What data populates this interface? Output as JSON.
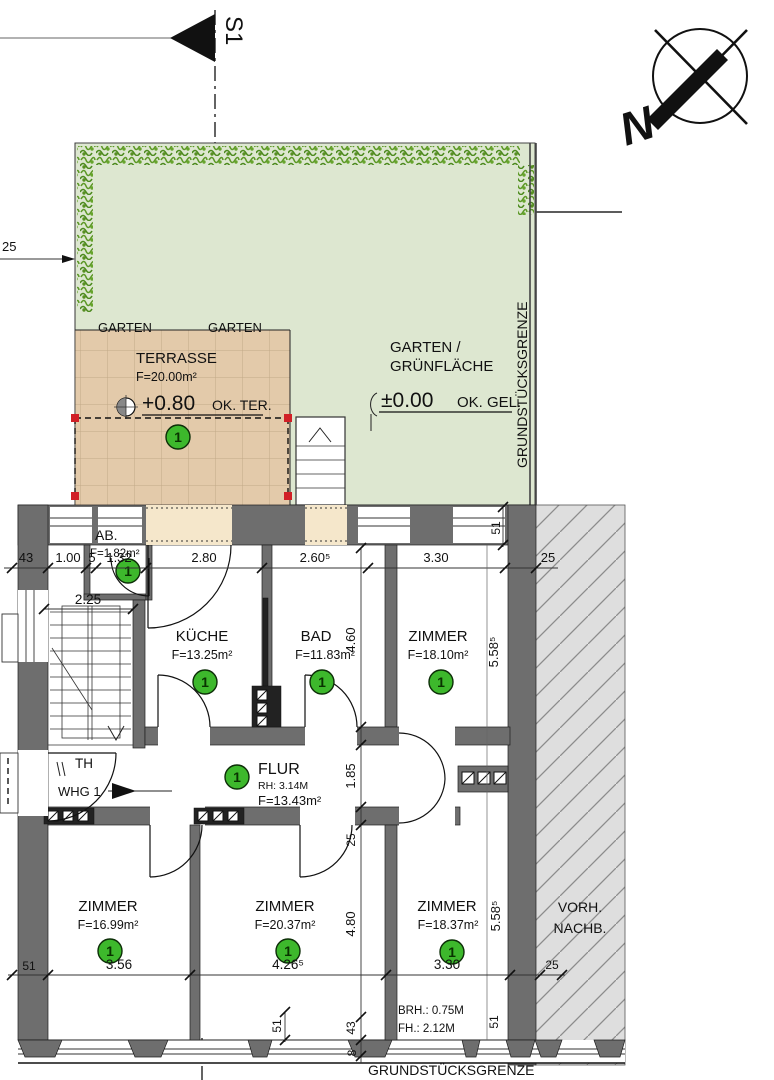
{
  "page": {
    "width": 774,
    "height": 1080,
    "background": "#ffffff"
  },
  "section_marker": {
    "label": "S1"
  },
  "compass": {
    "label": "N"
  },
  "site": {
    "property_line_right": "GRUNDSTÜCKSGRENZE",
    "property_line_bottom": "GRUNDSTÜCKSGRENZE",
    "garden": {
      "title_line1": "GARTEN /",
      "title_line2": "GRÜNFLÄCHE",
      "level": "±0.00",
      "level_ref": "OK. GEL.",
      "ghost_label": "GARTEN",
      "offset_dim": "25"
    },
    "terrace": {
      "title": "TERRASSE",
      "area": "F=20.00m²",
      "level": "+0.80",
      "level_ref": "OK. TER."
    },
    "neighbor": {
      "line1": "VORH.",
      "line2": "NACHB."
    }
  },
  "apartment": {
    "number": "1",
    "entrance_label": "WHG 1",
    "stairwell_label": "TH"
  },
  "rooms": {
    "ab": {
      "name": "AB.",
      "area": "F=1.82m²"
    },
    "kueche": {
      "name": "KÜCHE",
      "area": "F=13.25m²"
    },
    "bad": {
      "name": "BAD",
      "area": "F=11.83m²"
    },
    "zimmer_ne": {
      "name": "ZIMMER",
      "area": "F=18.10m²"
    },
    "flur": {
      "name": "FLUR",
      "clear_height": "RH: 3.14M",
      "area": "F=13.43m²"
    },
    "zimmer_sw": {
      "name": "ZIMMER",
      "area": "F=16.99m²"
    },
    "zimmer_s": {
      "name": "ZIMMER",
      "area": "F=20.37m²"
    },
    "zimmer_se": {
      "name": "ZIMMER",
      "area": "F=18.37m²"
    }
  },
  "window_note": {
    "line1": "BRH.: 0.75M",
    "line2": "FH.: 2.12M"
  },
  "dims": {
    "top": [
      "43",
      "1.00",
      "5",
      "1.32",
      "2.80",
      "2.60⁵",
      "3.30",
      "25"
    ],
    "stair_width": "2.25",
    "wall_top_right": "51",
    "v_bad": "4.60",
    "v_zimmer_ne": "5.58⁵",
    "v_flur": "1.85",
    "v_flur_wall": "25",
    "v_zimmer_s": "4.80",
    "v_zimmer_se": "5.58⁵",
    "bottom_wall_left": "51",
    "bottom": [
      "3.56",
      "4.26⁵",
      "3.30"
    ],
    "neighbor_offset": "25",
    "sill_51": "51",
    "sill_43": "43",
    "sill_8": "8",
    "wall_bottom_right": "51"
  },
  "colors": {
    "garden": "#dde7d0",
    "hedge": "#5d9827",
    "terrace": "#e3caaa",
    "terrace_grid": "#c2a988",
    "wall": "#6e6e6e",
    "neighbor_bg": "#dedede",
    "hatch_line": "#8c8c8c",
    "badge": "#3db82c",
    "marker_red": "#d11f26",
    "threshold": "#f5e7cb"
  }
}
